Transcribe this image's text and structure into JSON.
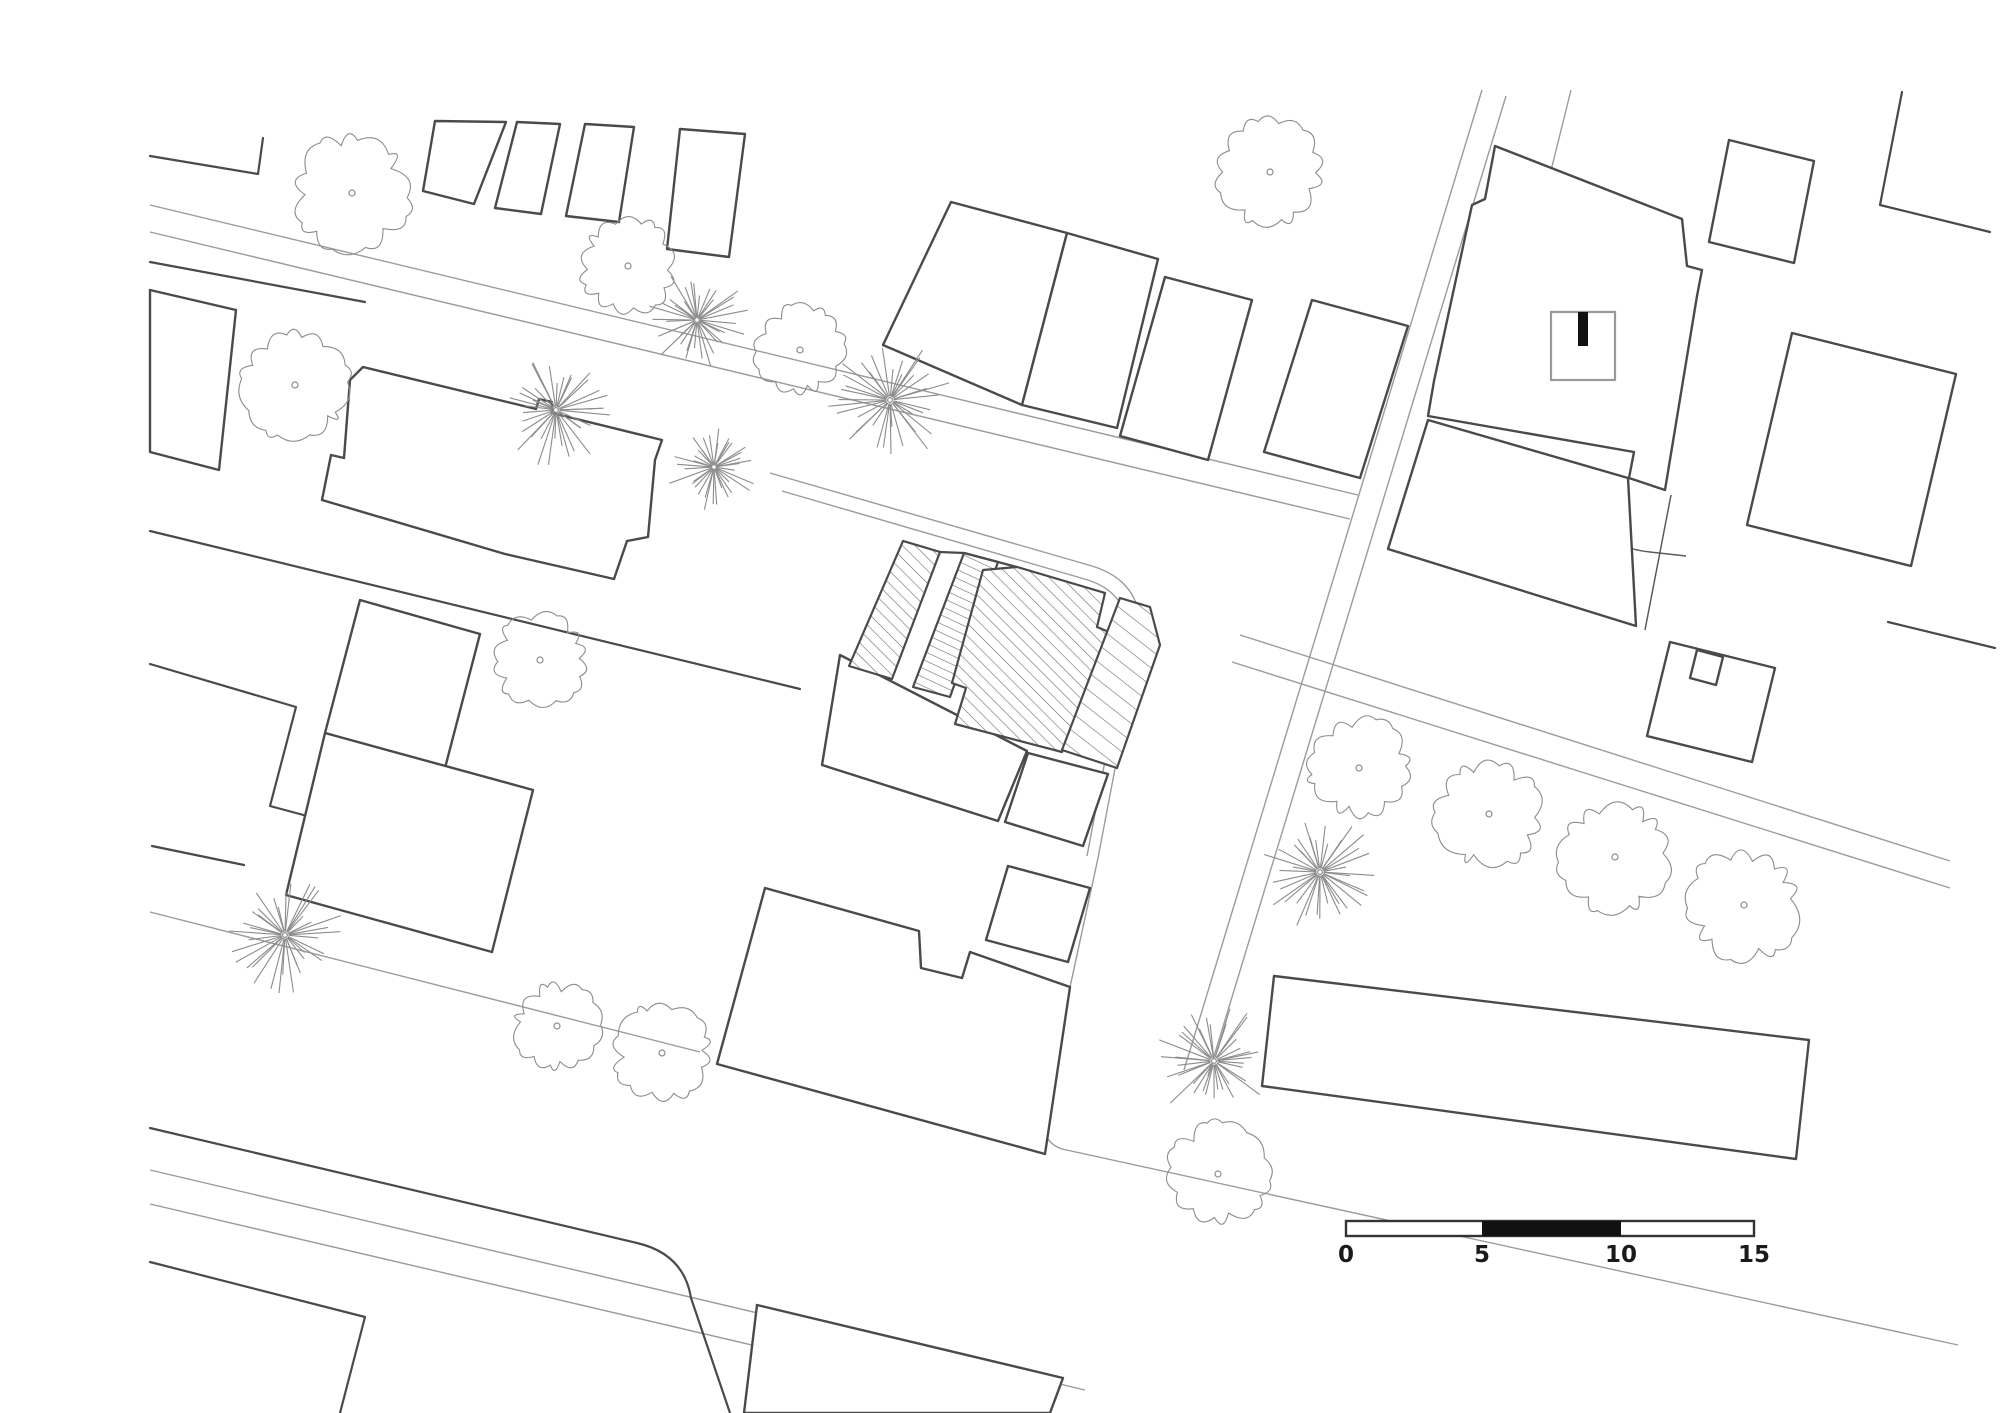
{
  "title": "Urban site plan drawing",
  "colors": {
    "background": "#ffffff",
    "building_outline": "#4a4a4a",
    "street_line": "#9b9b9b",
    "hatch": "#6e6e6e",
    "scale_black": "#111111",
    "label_text": "#1a1a1a"
  },
  "scale_bar": {
    "labels": [
      "0",
      "5",
      "10",
      "15"
    ],
    "values": [
      0,
      5,
      10,
      15
    ],
    "unit": "m",
    "x_positions": [
      1346,
      1482,
      1621,
      1754
    ],
    "bar": {
      "x": 1346,
      "y": 1221,
      "width": 408,
      "height": 15,
      "black_from_x": 1482,
      "black_to_x": 1621
    },
    "label_y": 1262
  },
  "entrance_symbol": {
    "description": "square with black bar marker inside top-right building",
    "square": {
      "x": 1551,
      "y": 312,
      "width": 64,
      "height": 68
    },
    "bar": {
      "x": 1578,
      "y": 312,
      "width": 10,
      "height": 34
    }
  },
  "site_plan": {
    "roads": [
      "M150,205 L1358,495",
      "M150,232 L1350,519",
      "M770,473 L1092,566 Q1150,584 1138,648 L1098,858 L1046,1098 Q1035,1140 1062,1149 L1958,1345",
      "M782,491 L1088,580 Q1136,596 1126,650 L1087,856",
      "M1482,90 L1184,1070",
      "M1506,96 L1208,1076",
      "M1571,90 L1497,388",
      "M1240,635 L1950,861",
      "M1232,662 L1950,888",
      "M150,1170 L1085,1390",
      "M150,1204 L1042,1413",
      "M150,912 L700,1052"
    ],
    "dark_lines": [
      "M150,156 L258,174 L263,138",
      "M150,262 L365,302",
      "M150,531 L800,689",
      "M150,664 L296,707 L270,806 L322,820",
      "M152,846 L244,865",
      "M150,1128 L637,1243 Q684,1254 691,1298 L730,1413",
      "M903,541 L940,552 L964,553 L998,562 L1017,567 L1105,593",
      "M150,1262 L365,1317 L340,1413",
      "M1902,92 L1880,205 L1990,232",
      "M1888,622 L1995,648"
    ],
    "thin_dark_lines": [
      "M1583,468 L1583,492 C1587,526 1610,548 1650,552 L1686,556",
      "M1671,495 L1645,630",
      "M445,766 L410,906"
    ],
    "buildings": [
      "M435,121 L506,122 L474,204 L423,191 Z",
      "M517,122 L560,124 L541,214 L495,208 Z",
      "M585,124 L634,127 L619,222 L566,216 Z",
      "M680,129 L745,134 L729,257 L667,249 Z",
      "M951,202 L1067,233 L1022,405 L883,345 Z",
      "M1067,233 L1158,259 L1117,428 L1022,405 Z",
      "M1165,277 L1252,300 L1208,460 L1120,436 Z",
      "M1312,300 L1408,326 L1360,478 L1264,452 Z",
      "M363,367 L536,409 L539,399 L552,402 L552,413 L662,440 L655,460 L648,537 L627,541 L614,579 L505,554 L322,500 L331,455 L344,458 L350,380 Z",
      "M150,290 L236,310 L219,470 L150,452 Z",
      "M360,600 L480,634 L445,768 L325,733 Z",
      "M325,733 L533,790 L492,952 L286,895 Z",
      "M840,655 L1027,751 L998,821 L822,765 Z",
      "M1028,753 L1108,774 L1083,846 L1005,822 Z",
      "M1008,866 L1090,888 L1068,962 L986,940 Z",
      "M765,888 L919,931 L921,968 L962,978 L970,952 L1070,987 L1045,1154 L717,1064 Z",
      "M1274,976 L1809,1040 L1796,1159 L1262,1086 Z",
      "M1485,199 L1495,146 L1682,219 L1687,266 L1702,270 L1697,296 L1665,490 L1629,478 L1634,452 L1428,416 L1434,381 L1472,205 Z",
      "M1428,420 L1628,478 L1636,626 L1388,549 Z",
      "M1670,642 L1775,668 L1752,762 L1647,736 Z",
      "M1697,650 L1723,657 L1716,685 L1690,678 Z",
      "M1729,140 L1814,161 L1794,263 L1709,242 Z",
      "M1792,333 L1956,374 L1911,566 L1747,525 Z",
      "M757,1305 L1063,1378 L1050,1413 L744,1413 Z"
    ],
    "hatched_buildings": [
      {
        "d": "M903,541 L940,552 L892,679 L849,666 Z",
        "pattern": "hatchA"
      },
      {
        "d": "M964,553 L998,562 L950,697 L913,687 Z",
        "pattern": "hatchC"
      },
      {
        "d": "M1017,567 L1105,593 L1097,627 L1109,632 L1062,752 L955,724 L966,688 L952,683 L983,570 Z",
        "pattern": "hatchA"
      },
      {
        "d": "M1120,598 L1150,607 L1160,645 L1117,768 L1062,750 Z",
        "pattern": "hatchB"
      }
    ],
    "trees_deciduous": [
      {
        "x": 352,
        "y": 193,
        "r": 60
      },
      {
        "x": 628,
        "y": 266,
        "r": 50
      },
      {
        "x": 800,
        "y": 350,
        "r": 46
      },
      {
        "x": 1270,
        "y": 172,
        "r": 55
      },
      {
        "x": 295,
        "y": 385,
        "r": 55
      },
      {
        "x": 540,
        "y": 660,
        "r": 48
      },
      {
        "x": 557,
        "y": 1026,
        "r": 45
      },
      {
        "x": 662,
        "y": 1053,
        "r": 50
      },
      {
        "x": 1218,
        "y": 1174,
        "r": 52
      },
      {
        "x": 1359,
        "y": 768,
        "r": 52
      },
      {
        "x": 1489,
        "y": 814,
        "r": 55
      },
      {
        "x": 1615,
        "y": 857,
        "r": 57
      },
      {
        "x": 1744,
        "y": 905,
        "r": 58
      }
    ],
    "trees_conifer": [
      {
        "x": 890,
        "y": 400,
        "r": 62
      },
      {
        "x": 556,
        "y": 410,
        "r": 58
      },
      {
        "x": 714,
        "y": 467,
        "r": 48
      },
      {
        "x": 285,
        "y": 935,
        "r": 60
      },
      {
        "x": 1320,
        "y": 872,
        "r": 62
      },
      {
        "x": 1214,
        "y": 1061,
        "r": 62
      },
      {
        "x": 697,
        "y": 320,
        "r": 52
      }
    ]
  }
}
